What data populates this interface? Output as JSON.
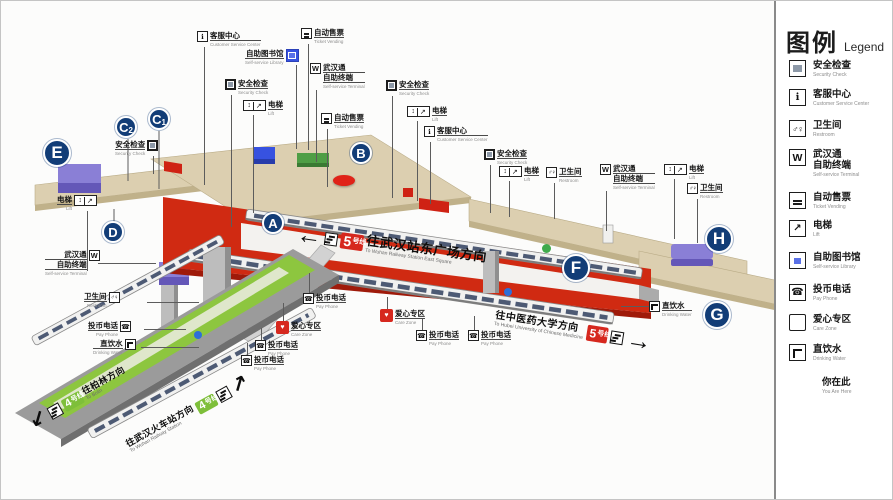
{
  "legend": {
    "title_zh": "图例",
    "title_en": "Legend",
    "items": [
      {
        "icon": "security",
        "zh": "安全检查",
        "en": "Security Check"
      },
      {
        "icon": "service",
        "zh": "客服中心",
        "en": "Customer Service Center"
      },
      {
        "icon": "restroom",
        "zh": "卫生间",
        "en": "Restroom"
      },
      {
        "icon": "wuhantong",
        "zh": "武汉通",
        "zh2": "自助终端",
        "en": "Self-service Terminal"
      },
      {
        "icon": "ticket",
        "zh": "自动售票",
        "en": "Ticket Vending"
      },
      {
        "icon": "lift",
        "zh": "电梯",
        "en": "Lift"
      },
      {
        "icon": "library",
        "zh": "自助图书馆",
        "en": "Self-service Library"
      },
      {
        "icon": "phone",
        "zh": "投币电话",
        "en": "Pay Phone"
      },
      {
        "icon": "care",
        "zh": "爱心专区",
        "en": "Care Zone"
      },
      {
        "icon": "water",
        "zh": "直饮水",
        "en": "Drinking Water"
      },
      {
        "icon": "youarehere",
        "zh": "你在此",
        "en": "You Are Here"
      }
    ]
  },
  "line5": {
    "badge": {
      "num": "5",
      "suffix": "号线",
      "en": "Line 5"
    },
    "dir_left": {
      "zh": "往武汉站东广场方向",
      "en": "To Wuhan Railway Station East Square"
    },
    "dir_right": {
      "zh": "往中医药大学方向",
      "en": "To Hubei University of Chinese Medicine"
    }
  },
  "line4": {
    "badge": {
      "num": "4",
      "suffix": "号线",
      "en": "Line 4"
    },
    "dir_sw": {
      "zh": "往柏林方向",
      "en": "To Bolin"
    },
    "dir_ne": {
      "zh": "往武汉火车站方向",
      "en": "To Wuhan Railway Station"
    }
  },
  "arrows": {
    "left": "←",
    "right": "→",
    "sw": "↙",
    "ne": "↗"
  },
  "colors": {
    "line5_red": "#d6281e",
    "line4_green": "#7ebf3a",
    "marker_navy": "#123d77",
    "library_blue": "#3752e0",
    "care_red": "#d6281e",
    "you_are_here_red": "#e02318",
    "concourse_beige": "#dccfb0"
  },
  "markers": [
    {
      "label": "A",
      "x": 272,
      "y": 222
    },
    {
      "label": "B",
      "x": 360,
      "y": 152
    },
    {
      "label": "C",
      "sub": "1",
      "x": 158,
      "y": 118
    },
    {
      "label": "C",
      "sub": "2",
      "x": 125,
      "y": 126
    },
    {
      "label": "D",
      "x": 112,
      "y": 231
    },
    {
      "label": "E",
      "x": 56,
      "y": 152,
      "big": true
    },
    {
      "label": "F",
      "x": 575,
      "y": 267,
      "big": true
    },
    {
      "label": "G",
      "x": 716,
      "y": 314,
      "big": true
    },
    {
      "label": "H",
      "x": 718,
      "y": 238,
      "big": true
    }
  ],
  "callouts": [
    {
      "icon": "service",
      "zh": "客服中心",
      "en": "Customer Service Center",
      "x": 196,
      "y": 30,
      "lx": 203,
      "ly": 46,
      "ll": 138
    },
    {
      "icon": "ticket",
      "zh": "自动售票",
      "en": "Ticket Vending",
      "x": 300,
      "y": 27,
      "lx": 307,
      "ly": 43,
      "ll": 106
    },
    {
      "icon": "library",
      "zh": "自助图书馆",
      "en": "Self-service Library",
      "x": 244,
      "y": 48,
      "rev": true,
      "lx": 295,
      "ly": 64,
      "ll": 84
    },
    {
      "icon": "wuhantong",
      "zh": "武汉通",
      "zh2": "自助终端",
      "en": "Self-service Terminal",
      "x": 309,
      "y": 62,
      "lx": 315,
      "ly": 89,
      "ll": 72
    },
    {
      "icon": "security",
      "zh": "安全检查",
      "en": "Security Check",
      "x": 224,
      "y": 78,
      "lx": 230,
      "ly": 94,
      "ll": 132
    },
    {
      "icon": "lift2",
      "zh": "电梯",
      "en": "Lift",
      "x": 242,
      "y": 99,
      "lx": 252,
      "ly": 114,
      "ll": 98
    },
    {
      "icon": "ticket",
      "zh": "自动售票",
      "en": "Ticket Vending",
      "x": 320,
      "y": 112,
      "lx": 326,
      "ly": 128,
      "ll": 58
    },
    {
      "icon": "security",
      "zh": "安全检查",
      "en": "Security Check",
      "x": 385,
      "y": 79,
      "lx": 391,
      "ly": 95,
      "ll": 102
    },
    {
      "icon": "lift2",
      "zh": "电梯",
      "en": "Lift",
      "x": 406,
      "y": 105,
      "lx": 416,
      "ly": 120,
      "ll": 80
    },
    {
      "icon": "service",
      "zh": "客服中心",
      "en": "Customer Service Center",
      "x": 423,
      "y": 125,
      "lx": 429,
      "ly": 141,
      "ll": 62
    },
    {
      "icon": "security",
      "zh": "安全检查",
      "en": "Security Check",
      "x": 483,
      "y": 148,
      "lx": 489,
      "ly": 164,
      "ll": 48
    },
    {
      "icon": "lift2",
      "zh": "电梯",
      "en": "Lift",
      "x": 498,
      "y": 165,
      "lx": 508,
      "ly": 180,
      "ll": 36
    },
    {
      "icon": "restroom",
      "zh": "卫生间",
      "en": "Restroom",
      "x": 545,
      "y": 166,
      "lx": 553,
      "ly": 182,
      "ll": 36
    },
    {
      "icon": "wuhantong",
      "zh": "武汉通",
      "zh2": "自助终端",
      "en": "Self-service Terminal",
      "x": 599,
      "y": 163,
      "lx": 605,
      "ly": 190,
      "ll": 40
    },
    {
      "icon": "lift2",
      "zh": "电梯",
      "en": "Lift",
      "x": 663,
      "y": 163,
      "lx": 673,
      "ly": 178,
      "ll": 60
    },
    {
      "icon": "restroom",
      "zh": "卫生间",
      "en": "Restroom",
      "x": 686,
      "y": 182,
      "lx": 696,
      "ly": 198,
      "ll": 44
    },
    {
      "icon": "security",
      "zh": "安全检查",
      "en": "Security Check",
      "x": 114,
      "y": 139,
      "rev": true,
      "lx": 152,
      "ly": 155,
      "ll": 18
    },
    {
      "icon": "lift2",
      "zh": "电梯",
      "en": "Lift",
      "x": 56,
      "y": 194,
      "rev": true,
      "lx": 86,
      "ly": 210,
      "ll": 60
    },
    {
      "icon": "wuhantong",
      "zh": "武汉通",
      "zh2": "自助终端",
      "en": "Self-service Terminal",
      "x": 44,
      "y": 249,
      "rev": true,
      "lx": 97,
      "ly": 262,
      "ll": 58,
      "h": true
    },
    {
      "icon": "restroom",
      "zh": "卫生间",
      "en": "Restroom",
      "x": 83,
      "y": 291,
      "rev": true,
      "lx": 146,
      "ly": 301,
      "ll": 52,
      "h": true
    },
    {
      "icon": "phone",
      "zh": "投币电话",
      "en": "Pay Phone",
      "x": 87,
      "y": 320,
      "rev": true,
      "lx": 143,
      "ly": 328,
      "ll": 42,
      "h": true
    },
    {
      "icon": "water",
      "zh": "直饮水",
      "en": "Drinking Water",
      "x": 92,
      "y": 338,
      "rev": true,
      "lx": 140,
      "ly": 346,
      "ll": 58,
      "h": true
    },
    {
      "icon": "phone",
      "zh": "投币电话",
      "en": "Pay Phone",
      "x": 302,
      "y": 292,
      "lx": 308,
      "ly": 272,
      "ll": 20
    },
    {
      "icon": "care",
      "zh": "爱心专区",
      "en": "Care Zone",
      "x": 275,
      "y": 320,
      "lx": 282,
      "ly": 302,
      "ll": 18
    },
    {
      "icon": "phone",
      "zh": "投币电话",
      "en": "Pay Phone",
      "x": 254,
      "y": 339,
      "lx": 260,
      "ly": 327,
      "ll": 12
    },
    {
      "icon": "phone",
      "zh": "投币电话",
      "en": "Pay Phone",
      "x": 240,
      "y": 354,
      "lx": 246,
      "ly": 342,
      "ll": 12
    },
    {
      "icon": "care",
      "zh": "爱心专区",
      "en": "Care Zone",
      "x": 379,
      "y": 308,
      "lx": 386,
      "ly": 296,
      "ll": 12
    },
    {
      "icon": "phone",
      "zh": "投币电话",
      "en": "Pay Phone",
      "x": 415,
      "y": 329,
      "lx": 421,
      "ly": 317,
      "ll": 12
    },
    {
      "icon": "phone",
      "zh": "投币电话",
      "en": "Pay Phone",
      "x": 467,
      "y": 329,
      "lx": 473,
      "ly": 315,
      "ll": 14
    },
    {
      "icon": "water",
      "zh": "直饮水",
      "en": "Drinking Water",
      "x": 648,
      "y": 300,
      "lx": 620,
      "ly": 305,
      "ll": 28,
      "h": true
    }
  ]
}
